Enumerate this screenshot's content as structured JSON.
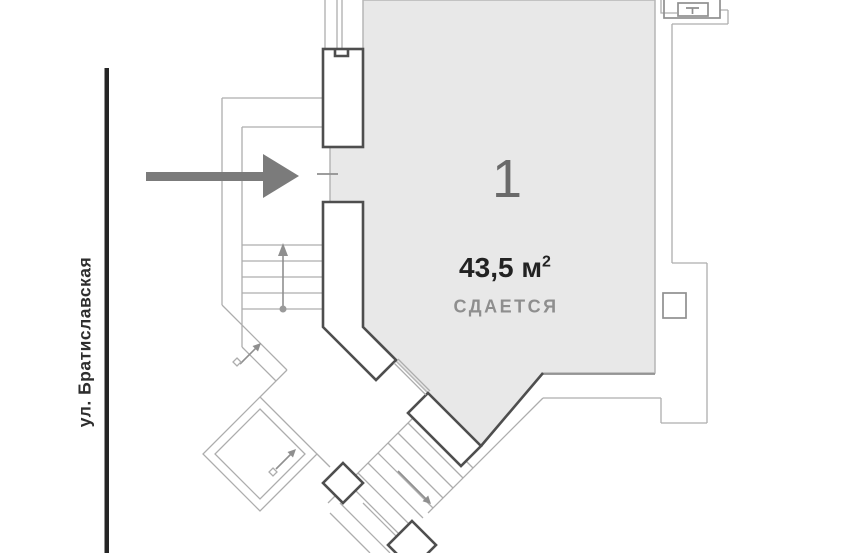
{
  "floor_plan": {
    "street": {
      "label": "ул. Братиславская"
    },
    "unit": {
      "number": "1",
      "area": "43,5 м",
      "area_sup": "2",
      "status": "СДАЕТСЯ"
    },
    "icons": {
      "entrance_arrow": "right-arrow",
      "stairs_up_arrow": "up-arrow",
      "stairs_diagonal_arrows": "northeast-arrows",
      "stairs_down_arrow": "southeast-arrow",
      "door_symbol": "door-dash",
      "technical_box": "T-symbol"
    },
    "colors": {
      "unit_fill": "#e8e8e8",
      "unit_border": "#b6b6b6",
      "wall": "#4e4e4e",
      "thin_line": "#adadad",
      "medium_line": "#8f8f8f",
      "arrow": "#7b7b7b",
      "street_line": "#252525",
      "unit_number_color": "#6a6a6a",
      "area_text_color": "#222222",
      "status_color": "#8e8e8e"
    }
  }
}
